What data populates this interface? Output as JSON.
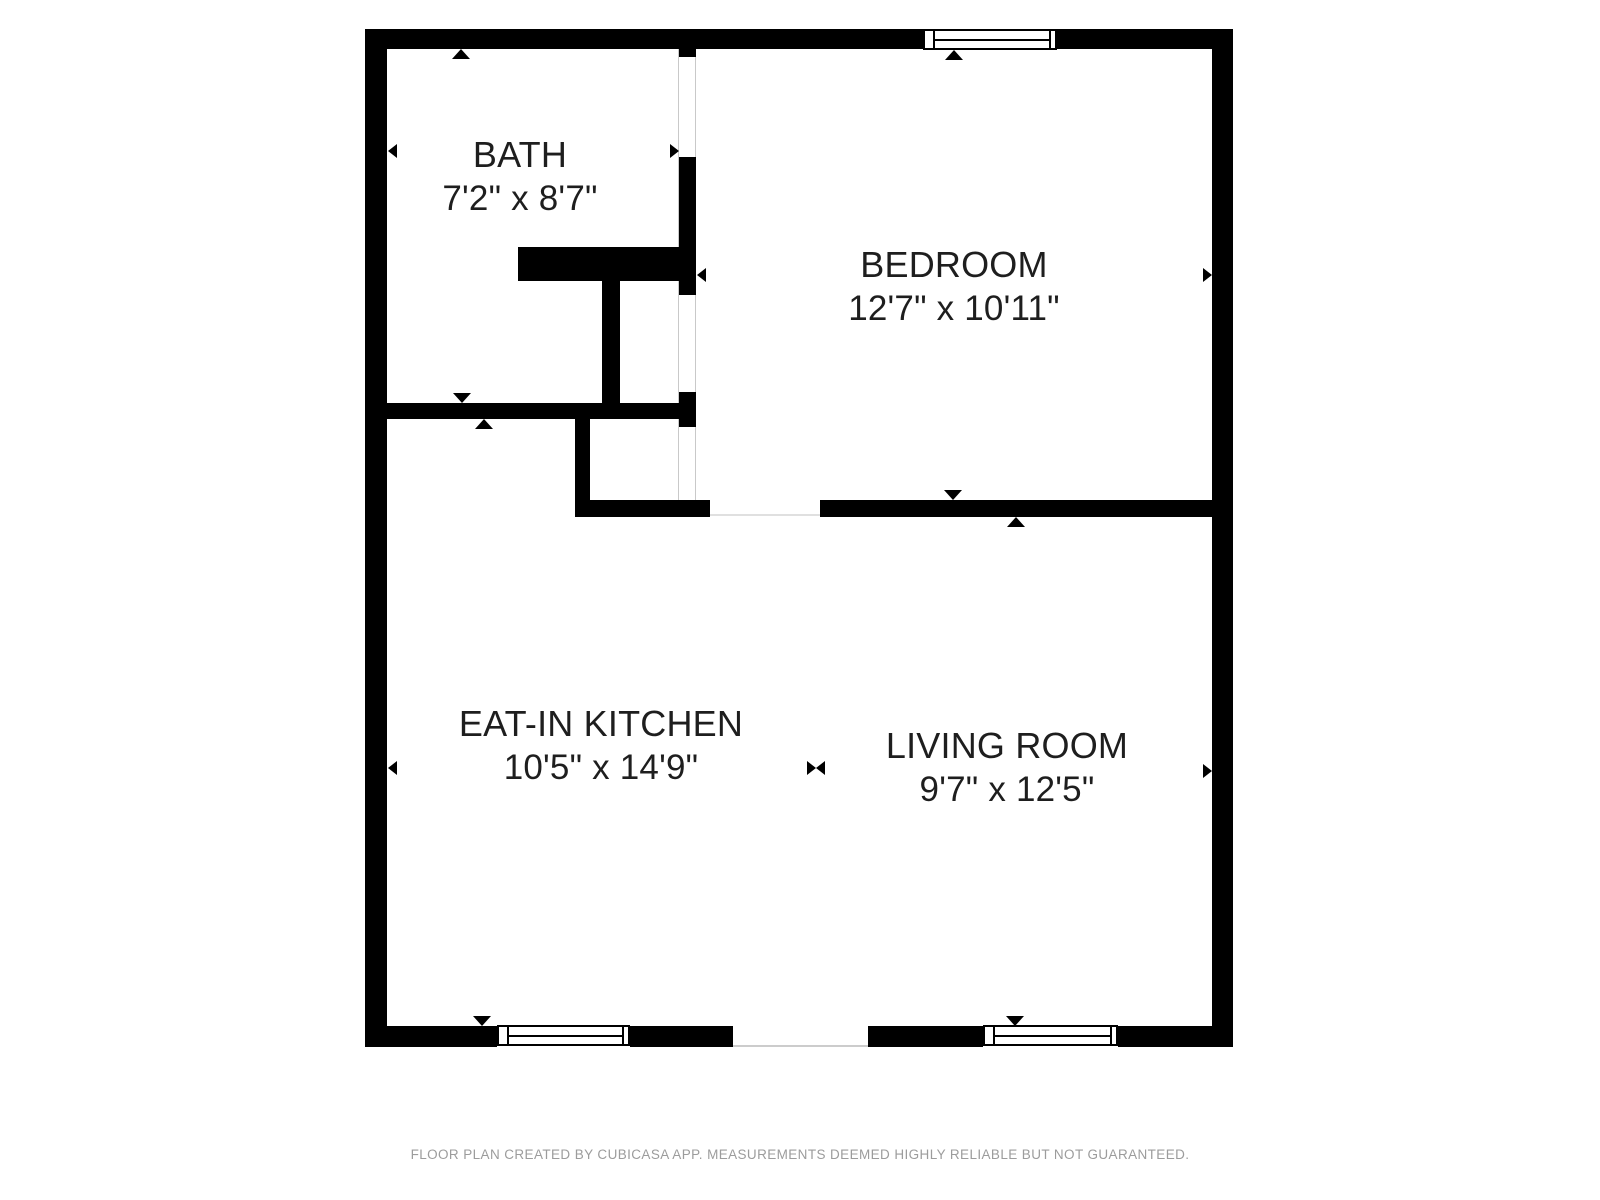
{
  "colors": {
    "background": "#ffffff",
    "wall": "#000000",
    "label_text": "#1e1e1e",
    "footer_text": "#9c9c9c",
    "opening_line": "#c9c9c9",
    "threshold_line": "#dddddd"
  },
  "rooms": [
    {
      "key": "bath",
      "name": "BATH",
      "dimensions": "7'2\" x 8'7\"",
      "cx": 520,
      "cy": 177
    },
    {
      "key": "bedroom",
      "name": "BEDROOM",
      "dimensions": "12'7\" x 10'11\"",
      "cx": 954,
      "cy": 287
    },
    {
      "key": "kitchen",
      "name": "EAT-IN KITCHEN",
      "dimensions": "10'5\" x 14'9\"",
      "cx": 601,
      "cy": 746
    },
    {
      "key": "living",
      "name": "LIVING ROOM",
      "dimensions": "9'7\" x 12'5\"",
      "cx": 1007,
      "cy": 768
    }
  ],
  "footer": {
    "text": "FLOOR PLAN CREATED BY CUBICASA APP. MEASUREMENTS DEEMED HIGHLY RELIABLE BUT NOT GUARANTEED."
  },
  "floorplan": {
    "lines_under": [
      {
        "x": 677.5,
        "y": 49,
        "w": 1.5,
        "h": 451,
        "color": "#c9c9c9"
      },
      {
        "x": 694.5,
        "y": 49,
        "w": 1.5,
        "h": 451,
        "color": "#c9c9c9"
      },
      {
        "x": 710,
        "y": 514,
        "w": 110,
        "h": 1.5,
        "color": "#e0e0e0"
      }
    ],
    "walls": [
      {
        "name": "outer-top",
        "x": 365,
        "y": 29,
        "w": 868,
        "h": 20
      },
      {
        "name": "outer-bottom",
        "x": 365,
        "y": 1026,
        "w": 868,
        "h": 21
      },
      {
        "name": "outer-left",
        "x": 365,
        "y": 29,
        "w": 22,
        "h": 1018
      },
      {
        "name": "outer-right",
        "x": 1212,
        "y": 29,
        "w": 21,
        "h": 1018
      },
      {
        "name": "bath-bedroom-stub",
        "x": 679,
        "y": 49,
        "w": 17,
        "h": 8
      },
      {
        "name": "bath-bedroom-mid",
        "x": 679,
        "y": 157,
        "w": 17,
        "h": 138
      },
      {
        "name": "bath-bedroom-low",
        "x": 679,
        "y": 392,
        "w": 17,
        "h": 35
      },
      {
        "name": "bath-closet-top",
        "x": 518,
        "y": 247,
        "w": 178,
        "h": 34
      },
      {
        "name": "closet-left",
        "x": 602,
        "y": 281,
        "w": 18,
        "h": 122
      },
      {
        "name": "bath-bottom",
        "x": 387,
        "y": 403,
        "w": 309,
        "h": 16
      },
      {
        "name": "vestibule-left",
        "x": 575,
        "y": 419,
        "w": 15,
        "h": 81
      },
      {
        "name": "bedroom-bottom-left",
        "x": 575,
        "y": 500,
        "w": 135,
        "h": 17
      },
      {
        "name": "bedroom-bottom-right",
        "x": 820,
        "y": 500,
        "w": 392,
        "h": 17
      }
    ],
    "wall_gaps": [
      {
        "name": "top-window-gap",
        "x": 923,
        "y": 29,
        "w": 134,
        "h": 20
      },
      {
        "name": "kitchen-window-gap",
        "x": 497,
        "y": 1026,
        "w": 133,
        "h": 21
      },
      {
        "name": "entry-door-gap",
        "x": 733,
        "y": 1026,
        "w": 135,
        "h": 21
      },
      {
        "name": "living-window-gap",
        "x": 983,
        "y": 1026,
        "w": 135,
        "h": 21
      }
    ],
    "lines_over": [
      {
        "x": 733,
        "y": 1045,
        "w": 135,
        "h": 2,
        "color": "#cccccc"
      }
    ],
    "windows": [
      {
        "name": "bedroom-window",
        "x": 923,
        "y": 29,
        "w": 134,
        "h": 21
      },
      {
        "name": "kitchen-window",
        "x": 497,
        "y": 1025,
        "w": 133,
        "h": 21
      },
      {
        "name": "living-window",
        "x": 983,
        "y": 1025,
        "w": 135,
        "h": 21
      }
    ],
    "markers": [
      {
        "name": "measure-triangle-bath-top",
        "dir": "up",
        "x": 461,
        "y": 49
      },
      {
        "name": "measure-triangle-bath-left",
        "dir": "left",
        "x": 388,
        "y": 151
      },
      {
        "name": "measure-triangle-bath-right",
        "dir": "right",
        "x": 679,
        "y": 151
      },
      {
        "name": "measure-triangle-bath-bottom",
        "dir": "down",
        "x": 462,
        "y": 403
      },
      {
        "name": "measure-triangle-bedroom-top",
        "dir": "up",
        "x": 954,
        "y": 50
      },
      {
        "name": "measure-triangle-bedroom-left",
        "dir": "left",
        "x": 697,
        "y": 275
      },
      {
        "name": "measure-triangle-bedroom-right",
        "dir": "right",
        "x": 1212,
        "y": 275
      },
      {
        "name": "measure-triangle-bedroom-bottom",
        "dir": "down",
        "x": 953,
        "y": 500
      },
      {
        "name": "measure-triangle-kitchen-top",
        "dir": "up",
        "x": 484,
        "y": 419
      },
      {
        "name": "measure-triangle-kitchen-left",
        "dir": "left",
        "x": 388,
        "y": 768
      },
      {
        "name": "measure-triangle-kitchen-right",
        "dir": "right",
        "x": 816,
        "y": 768
      },
      {
        "name": "measure-triangle-living-left",
        "dir": "left",
        "x": 816,
        "y": 768
      },
      {
        "name": "measure-triangle-kitchen-bottom",
        "dir": "down",
        "x": 482,
        "y": 1026
      },
      {
        "name": "measure-triangle-living-top",
        "dir": "up",
        "x": 1016,
        "y": 517
      },
      {
        "name": "measure-triangle-living-right",
        "dir": "right",
        "x": 1212,
        "y": 771
      },
      {
        "name": "measure-triangle-living-bottom",
        "dir": "down",
        "x": 1015,
        "y": 1026
      }
    ]
  }
}
